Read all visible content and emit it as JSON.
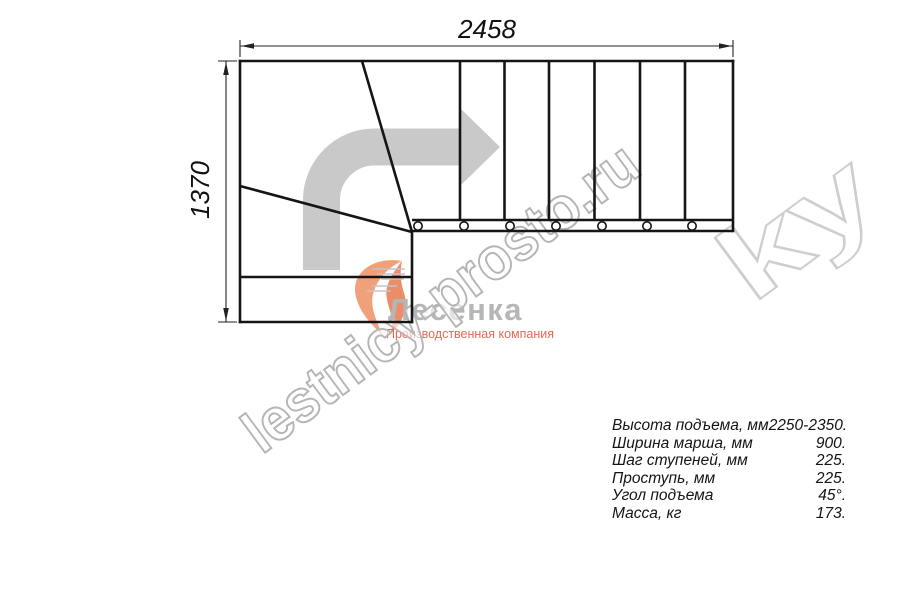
{
  "drawing": {
    "width_label": "2458",
    "height_label": "1370"
  },
  "specs": {
    "rows": [
      {
        "label": "Высота подъема, мм",
        "value": "2250-2350."
      },
      {
        "label": "Ширина марша, мм",
        "value": "900."
      },
      {
        "label": "Шаг ступеней, мм",
        "value": "225."
      },
      {
        "label": "Проступь, мм",
        "value": "225."
      },
      {
        "label": "Угол подъема",
        "value": "45°."
      },
      {
        "label": "Масса, кг",
        "value": "173."
      }
    ]
  },
  "watermark": {
    "text": "lestnicy-prosto.ru",
    "fragment": "ky"
  },
  "logo": {
    "name": "Лесенка",
    "subtitle": "Производственная компания"
  },
  "colors": {
    "line_black": "#151515",
    "arrow_gray": "#c9c9c9",
    "watermark_outline": "#b5b5b5",
    "logo_orange": "#f0976c",
    "logo_text_gray": "#b6b6b6",
    "subtitle_orange": "#e06a55"
  }
}
